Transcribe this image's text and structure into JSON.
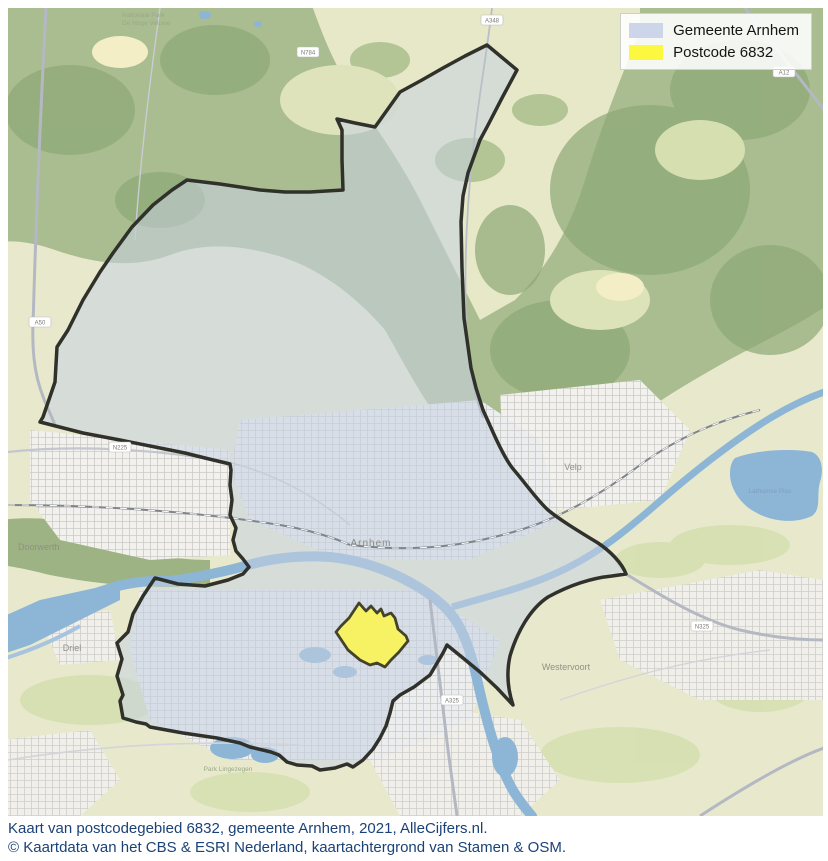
{
  "legend": {
    "items": [
      {
        "label": "Gemeente Arnhem",
        "color": "#ccd5e9"
      },
      {
        "label": "Postcode 6832",
        "color": "#fbf83f"
      }
    ]
  },
  "caption": {
    "line1": "Kaart van postcodegebied 6832, gemeente Arnhem, 2021, AlleCijfers.nl.",
    "line2": "© Kaartdata van het CBS & ESRI Nederland, kaartachtergrond van Stamen & OSM."
  },
  "map": {
    "regions": {
      "municipality": "Gemeente Arnhem",
      "postcode": "Postcode 6832"
    },
    "town_labels": [
      {
        "text": "Arnhem"
      },
      {
        "text": "Velp"
      },
      {
        "text": "Westervoort"
      },
      {
        "text": "Driel"
      },
      {
        "text": "Doorwerth"
      }
    ],
    "water_labels": [
      {
        "text": "Lathumse Plas"
      }
    ],
    "area_labels": [
      {
        "line1": "Nationaal Park",
        "line2": "De Hoge Veluwe"
      },
      {
        "text": "Park Lingezegen"
      }
    ],
    "road_labels": [
      {
        "text": "A50"
      },
      {
        "text": "N225"
      },
      {
        "text": "N784"
      },
      {
        "text": "A348"
      },
      {
        "text": "A12"
      },
      {
        "text": "N325"
      },
      {
        "text": "A325"
      }
    ],
    "colors": {
      "municipality_fill": "#c7d2e2",
      "postcode_fill": "#f6f263",
      "boundary": "#31312b",
      "water": "#8db5d6",
      "forest": "#aabd90",
      "field": "#e8e9cc"
    }
  }
}
